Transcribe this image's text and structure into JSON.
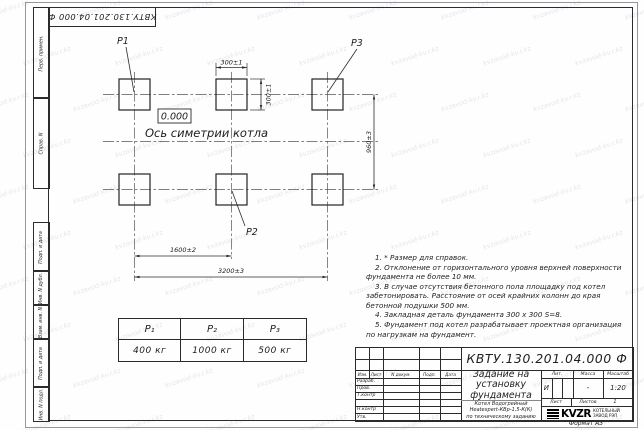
{
  "doc_number": "КВТУ.130.201.04.000  Ф",
  "watermark": {
    "text": "kvzavod-kv.r.kz"
  },
  "side_strips": {
    "top": [
      "Перв. примен.",
      "Справ. N"
    ],
    "bottom": [
      "Подп. и дата",
      "Инв. N дубл.",
      "Взам. инв. N",
      "Подп. и дата",
      "Инв. N подл."
    ]
  },
  "drawing": {
    "labels": {
      "p1": "P1",
      "p2": "P2",
      "p3": "P3"
    },
    "level_mark": "0.000",
    "axis_label": "Ось симетрии котла",
    "dimensions": {
      "pad_width": "300±1",
      "pad_height": "300±1",
      "row_spacing": "960±3",
      "col_spacing": "1600±2",
      "total_span": "3200±3"
    }
  },
  "notes": [
    "1. * Размер для справок.",
    "2. Отклонение от горизонтального уровня верхней поверхности фундамента не более 10 мм.",
    "3. В случае отсутствия бетонного пола площадку под котел забетонировать. Расстояние от осей крайних колонн до края бетонной подушки 500 мм.",
    "4. Закладная деталь фундамента  300 х 300  S=8.",
    "5. Фундамент под котел разрабатывает проектная организация по нагрузкам на фундамент."
  ],
  "load_table": {
    "headers": [
      "P₁",
      "P₂",
      "P₃"
    ],
    "values": [
      "400 кг",
      "1000 кг",
      "500 кг"
    ]
  },
  "title_block": {
    "title": "Задание на установку фундамента",
    "subtitle_lines": [
      "Котел Водогрейный",
      "Heatexpert-КВр-1,5-К(К)",
      "по техническому заданию"
    ],
    "columns": [
      "Изм.",
      "Лист",
      "N докум.",
      "Подп.",
      "Дата"
    ],
    "rows": [
      "Разраб.",
      "Пров.",
      "Т.контр",
      "Н.контр",
      "Утв."
    ],
    "lit_label": "Лит.",
    "lit_value": "И",
    "mass_label": "Масса",
    "mass_value": "-",
    "scale_label": "Масштаб",
    "scale_value": "1:20",
    "sheet_label": "Лист",
    "sheets_label": "Листов",
    "sheets_value": "1",
    "logo_text": "KVZR",
    "company": "КОТЕЛЬНЫЙ ЗАВОД РЭП",
    "format_label": "Формат А3"
  }
}
